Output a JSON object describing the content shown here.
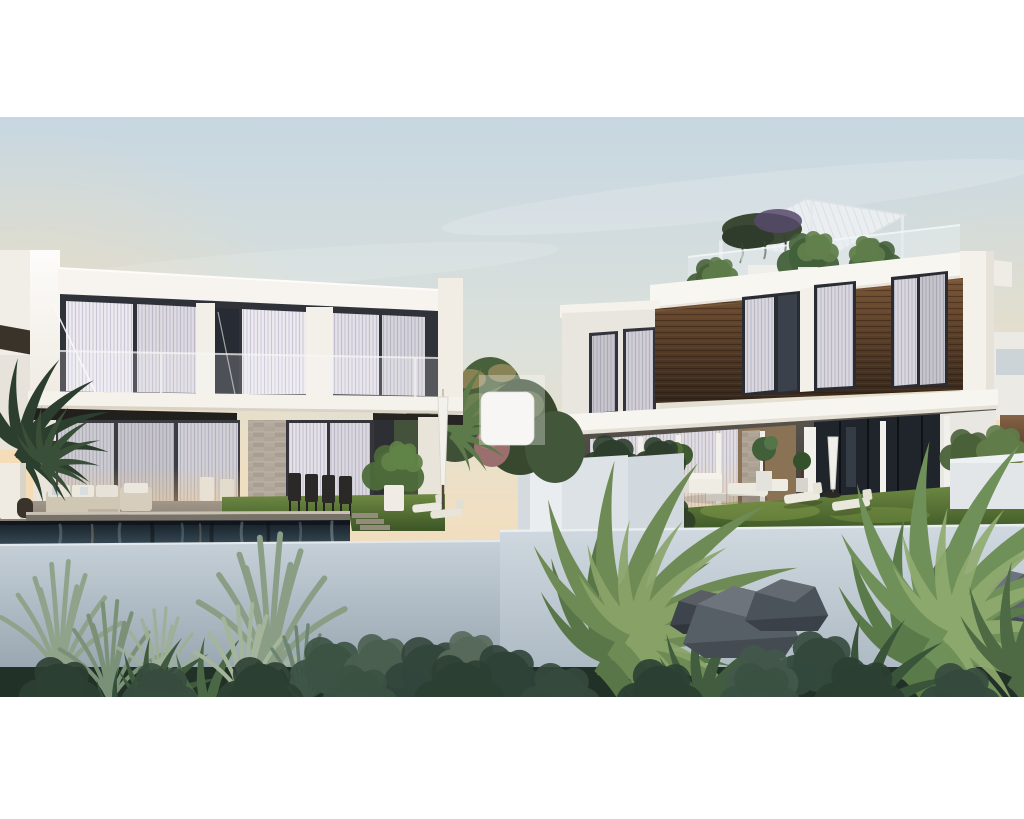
{
  "page": {
    "background_color": "#ffffff",
    "photo_top_px": 117,
    "photo_height_px": 580
  },
  "scene": {
    "description": "Dusk architectural rendering of two modern white villas: left villa with glass balcony and infinity pool, right villa with dark timber cladding and rooftop pergola terrace with planters; lawns, outdoor furniture and dense tropical planting in front of a light grey garden wall.",
    "style": "3D exterior render",
    "time_of_day": "dusk"
  },
  "palette": {
    "sky_top": "#c7d7e1",
    "sky_mid": "#dce1db",
    "sky_horizon": "#f0dfc2",
    "sky_low": "#f7d9ae",
    "sun_glow": "#ffd9a2",
    "villa_white": "#f7f4ef",
    "window_frame": "#2c2e36",
    "curtain_light": "#edebf0",
    "wood_light": "#7a5535",
    "wood_dark": "#35261a",
    "awning_dark": "#21201d",
    "stone": "#b3aa9d",
    "patio": "#a2978a",
    "lawn_light": "#6f8a43",
    "lawn_dark": "#3c5526",
    "pool_dark": "#141c23",
    "pool_light": "#4a5c66",
    "wall_left_top": "#c6d0d8",
    "wall_left_bottom": "#8f9ea9",
    "wall_right_top": "#d0d9e0",
    "wall_right_bottom": "#a7b4be",
    "foliage_base": "#223127",
    "foliage_dark": "#33463a",
    "foliage_mid": "#5a7456",
    "foliage_light": "#87a06b",
    "rock_dark": "#3c434a",
    "rock_light": "#667078"
  },
  "watermark": {
    "present": true,
    "shape": "rounded-square",
    "tile_color": "#f7f6f4",
    "backdrop_color": "#ffffff",
    "backdrop_opacity": 0.3
  }
}
